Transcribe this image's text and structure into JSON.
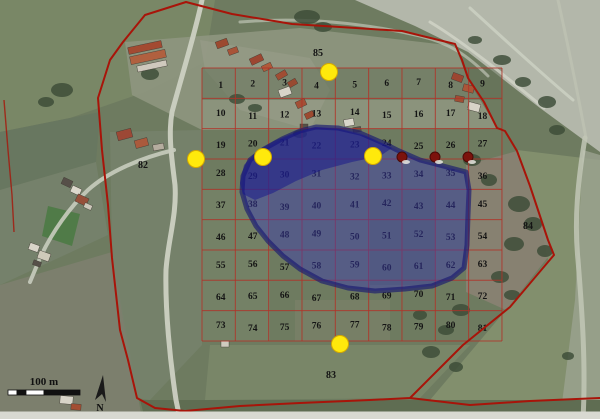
{
  "figure": {
    "kind": "satellite-map-with-sampling-grid",
    "width": 600,
    "height": 419
  },
  "colors": {
    "base_ground": "#6e7b60",
    "grid_line": "#b03328",
    "boundary_line": "#a81409",
    "flood_fill": "#3a3ab4",
    "flood_edge": "#191970",
    "flood_dark_patch": "#14148c",
    "sample_dot": "#ffe90c",
    "sample_dot_edge": "#d4a900",
    "well_dot": "#7c120c",
    "number_text": "#141414",
    "road": "#ccd0c2",
    "tree": "#3c4c37",
    "bottom_margin": "#d8d9d1"
  },
  "grid": {
    "x0": 202,
    "y0": 68,
    "cols": 9,
    "rows": 9,
    "cell_w": 33.33,
    "cell_h": 30.33,
    "numbers": [
      1,
      2,
      3,
      4,
      5,
      6,
      7,
      8,
      9,
      10,
      11,
      12,
      13,
      14,
      15,
      16,
      17,
      18,
      19,
      20,
      21,
      22,
      23,
      24,
      25,
      26,
      27,
      28,
      29,
      30,
      31,
      32,
      33,
      34,
      35,
      36,
      37,
      38,
      39,
      40,
      41,
      42,
      43,
      44,
      45,
      46,
      47,
      48,
      49,
      50,
      51,
      52,
      53,
      54,
      55,
      56,
      57,
      58,
      59,
      60,
      61,
      62,
      63,
      64,
      65,
      66,
      67,
      68,
      69,
      70,
      71,
      72,
      73,
      74,
      75,
      76,
      77,
      78,
      79,
      80,
      81
    ]
  },
  "outlying_labels": [
    {
      "text": "82",
      "x": 143,
      "y": 168
    },
    {
      "text": "83",
      "x": 331,
      "y": 378
    },
    {
      "text": "84",
      "x": 528,
      "y": 229
    },
    {
      "text": "85",
      "x": 318,
      "y": 56
    }
  ],
  "sample_points": [
    {
      "x": 329,
      "y": 72
    },
    {
      "x": 196,
      "y": 159
    },
    {
      "x": 263,
      "y": 157
    },
    {
      "x": 373,
      "y": 156
    },
    {
      "x": 340,
      "y": 344
    }
  ],
  "well_points": [
    {
      "x": 402,
      "y": 157
    },
    {
      "x": 435,
      "y": 157
    },
    {
      "x": 468,
      "y": 157
    }
  ],
  "boundary": {
    "main": "186,2 232,14 292,24 356,28 402,31 455,44 462,60 468,78 484,102 497,128 505,131 517,151 530,186 537,207 548,240 554,255 548,262 510,307 463,345 410,398 370,400 300,403 240,406 185,411 155,408 137,398 128,360 120,330 112,258 108,205 102,150 98,98 110,60 123,42 145,15",
    "bottom_ext": "410,398 470,405 530,401 600,398",
    "left_spur": "4,100 8,150 12,195 14,232"
  },
  "flood_zone": {
    "outline": "243,176 250,160 264,149 282,139 300,131 316,127 338,128 360,133 383,143 397,150 420,160 447,167 466,172 469,190 468,215 467,245 464,268 452,278 432,286 405,289 375,291 348,288 322,281 300,269 283,256 268,241 256,226 247,209 242,192",
    "dark_patch": "240,183 244,165 256,152 274,141 296,132 315,127 340,129 366,136 392,148 380,156 352,162 322,170 296,181 273,193 255,200 243,194"
  },
  "terrain": {
    "fields": [
      {
        "name": "tl-field-a",
        "pts": "0,0 215,0 205,62 145,92 70,118 0,132",
        "fill": "#798766",
        "op": 1
      },
      {
        "name": "tl-field-b",
        "pts": "0,132 100,112 96,162 0,190",
        "fill": "#687760",
        "op": 1
      },
      {
        "name": "tl-field-c",
        "pts": "0,190 96,162 108,235 0,285",
        "fill": "#75816b",
        "op": 1
      },
      {
        "name": "bl-field",
        "pts": "0,285 112,252 128,340 142,419 0,419",
        "fill": "#7c7f6d",
        "op": 1
      },
      {
        "name": "green-strip",
        "pts": "48,206 80,214 72,246 42,236",
        "fill": "#4d7a45",
        "op": 0.9
      },
      {
        "name": "top-band",
        "pts": "125,42 300,28 455,46 468,80 497,128 202,130 132,95",
        "fill": "#8e9680",
        "op": 0.9
      },
      {
        "name": "village-ground",
        "pts": "200,40 310,58 330,90 310,130 240,110 205,70",
        "fill": "#9a9d8a",
        "op": 0.6
      },
      {
        "name": "ne-scrubland",
        "pts": "355,0 600,0 600,152 540,108 468,52 415,26",
        "fill": "#b3b7aa",
        "op": 1
      },
      {
        "name": "e-zone",
        "pts": "517,150 600,160 600,400 430,400 548,260 537,207",
        "fill": "#84916f",
        "op": 0.9
      },
      {
        "name": "far-right-strip",
        "pts": "583,150 600,155 600,419 560,419 575,300",
        "fill": "#9ba390",
        "op": 0.8
      },
      {
        "name": "s-zone",
        "pts": "140,400 600,400 600,419 145,419",
        "fill": "#5f6d52",
        "op": 1
      },
      {
        "name": "se-field",
        "pts": "210,345 470,345 420,398 205,400",
        "fill": "#7b886a",
        "op": 0.85
      },
      {
        "name": "center-left",
        "pts": "110,132 202,130 202,345 150,400 137,398 125,330 112,255",
        "fill": "#76826c",
        "op": 0.9
      },
      {
        "name": "grid-top-row",
        "pts": "202,68 502,68 502,100 202,100",
        "fill": "#5f6e53",
        "op": 0.5
      },
      {
        "name": "grid-left-light",
        "pts": "202,190 270,190 270,341 202,341",
        "fill": "#7a886b",
        "op": 0.5
      },
      {
        "name": "grid-mid-dark",
        "pts": "370,190 435,190 435,285 370,285",
        "fill": "#5c6b51",
        "op": 0.45
      },
      {
        "name": "grid-bottom-tan",
        "pts": "295,300 390,300 390,341 295,341",
        "fill": "#80836b",
        "op": 0.5
      },
      {
        "name": "brown-ne-patch",
        "pts": "466,165 517,151 537,207 552,252 506,310 466,292",
        "fill": "#8a8273",
        "op": 0.9
      }
    ],
    "roads": [
      {
        "name": "main-road",
        "d": "M202,0 C196,30 182,75 172,112 C168,135 172,160 175,185 C177,215 168,240 166,270 C165,310 170,360 176,400 L180,419",
        "w": 5,
        "stroke": "#ccd0c2",
        "op": 0.95
      },
      {
        "name": "west-branch-road",
        "d": "M174,150 C140,158 108,172 88,190 C70,207 52,232 40,258 L30,282",
        "w": 4,
        "stroke": "#c8ccbe",
        "op": 0.9
      },
      {
        "name": "right-road",
        "d": "M585,138 C578,180 574,220 578,260 C582,310 586,365 583,419",
        "w": 5,
        "stroke": "#c2c7b6",
        "op": 0.85
      },
      {
        "name": "right-road-upper",
        "d": "M558,0 C568,45 578,95 586,138",
        "w": 3,
        "stroke": "#c2c7b6",
        "op": 0.6
      },
      {
        "name": "ne-trail",
        "d": "M240,22 C300,17 360,22 420,36 C450,43 468,56 488,76",
        "w": 3,
        "stroke": "#c5c9bb",
        "op": 0.65
      },
      {
        "name": "riverbed-streak",
        "d": "M430,22 C468,45 510,80 544,108",
        "w": 3,
        "stroke": "#d2d5c8",
        "op": 0.8
      },
      {
        "name": "riverbed-streak",
        "d": "M470,8 C505,40 543,75 573,100",
        "w": 3,
        "stroke": "#d2d5c8",
        "op": 0.7
      }
    ],
    "trees": [
      [
        307,
        17,
        13,
        7
      ],
      [
        323,
        27,
        9,
        5
      ],
      [
        237,
        99,
        8,
        5
      ],
      [
        255,
        108,
        7,
        4
      ],
      [
        150,
        74,
        9,
        6
      ],
      [
        62,
        90,
        11,
        7
      ],
      [
        46,
        102,
        8,
        5
      ],
      [
        519,
        204,
        11,
        8
      ],
      [
        533,
        224,
        9,
        7
      ],
      [
        514,
        244,
        10,
        7
      ],
      [
        545,
        251,
        8,
        6
      ],
      [
        500,
        277,
        9,
        6
      ],
      [
        512,
        295,
        8,
        5
      ],
      [
        472,
        160,
        9,
        6
      ],
      [
        489,
        180,
        8,
        6
      ],
      [
        461,
        310,
        9,
        6
      ],
      [
        446,
        330,
        8,
        5
      ],
      [
        431,
        352,
        9,
        6
      ],
      [
        456,
        367,
        7,
        5
      ],
      [
        568,
        356,
        6,
        4
      ],
      [
        502,
        60,
        9,
        5
      ],
      [
        523,
        82,
        8,
        5
      ],
      [
        547,
        102,
        9,
        6
      ],
      [
        475,
        40,
        7,
        4
      ],
      [
        557,
        130,
        8,
        5
      ],
      [
        420,
        315,
        7,
        5
      ],
      [
        300,
        134,
        7,
        4
      ]
    ],
    "buildings": [
      [
        128,
        44,
        34,
        7,
        -12,
        "#a34a32"
      ],
      [
        130,
        53,
        36,
        8,
        -12,
        "#b0603f"
      ],
      [
        137,
        63,
        30,
        6,
        -12,
        "#cfc9bd"
      ],
      [
        216,
        40,
        12,
        7,
        -20,
        "#9c4a30"
      ],
      [
        228,
        48,
        10,
        6,
        -20,
        "#a85438"
      ],
      [
        250,
        56,
        13,
        7,
        -25,
        "#9c4631"
      ],
      [
        262,
        64,
        10,
        6,
        -25,
        "#b05a3a"
      ],
      [
        276,
        72,
        11,
        6,
        -30,
        "#a04d33"
      ],
      [
        288,
        80,
        9,
        6,
        -30,
        "#984a31"
      ],
      [
        279,
        88,
        12,
        8,
        -20,
        "#d8d4c8"
      ],
      [
        296,
        100,
        10,
        7,
        -25,
        "#a35036"
      ],
      [
        305,
        112,
        9,
        6,
        -25,
        "#9c4a30"
      ],
      [
        300,
        124,
        8,
        6,
        0,
        "#574f47"
      ],
      [
        344,
        119,
        10,
        7,
        -10,
        "#d9d6cb"
      ],
      [
        353,
        127,
        8,
        5,
        -10,
        "#5a544c"
      ],
      [
        452,
        74,
        11,
        7,
        20,
        "#9c4631"
      ],
      [
        463,
        85,
        11,
        7,
        15,
        "#aa5638"
      ],
      [
        455,
        96,
        9,
        6,
        10,
        "#a04d33"
      ],
      [
        468,
        103,
        12,
        8,
        15,
        "#d7d3c7"
      ],
      [
        117,
        130,
        15,
        9,
        -15,
        "#9c4835"
      ],
      [
        135,
        139,
        13,
        8,
        -15,
        "#aa5a3c"
      ],
      [
        153,
        144,
        11,
        6,
        -10,
        "#b5ad9f"
      ],
      [
        62,
        179,
        10,
        7,
        25,
        "#564f48"
      ],
      [
        71,
        187,
        10,
        7,
        25,
        "#dcd8cc"
      ],
      [
        76,
        196,
        12,
        8,
        25,
        "#96503a"
      ],
      [
        84,
        204,
        8,
        5,
        25,
        "#ccc7ba"
      ],
      [
        29,
        244,
        10,
        7,
        20,
        "#d9d5c9"
      ],
      [
        38,
        252,
        12,
        8,
        20,
        "#cfcaba"
      ],
      [
        33,
        261,
        8,
        5,
        20,
        "#565049"
      ],
      [
        60,
        396,
        13,
        8,
        5,
        "#d8d4c8"
      ],
      [
        71,
        404,
        10,
        6,
        5,
        "#a34e33"
      ],
      [
        221,
        341,
        8,
        6,
        0,
        "#cfcbbf"
      ]
    ]
  },
  "scale_bar": {
    "label": "100 m",
    "x": 8,
    "y": 390,
    "h": 5,
    "segments": [
      {
        "w": 9,
        "fill": "#ffffff"
      },
      {
        "w": 9,
        "fill": "#111111"
      },
      {
        "w": 18,
        "fill": "#ffffff"
      },
      {
        "w": 36,
        "fill": "#111111"
      }
    ]
  },
  "north_arrow": {
    "label": "N",
    "x": 101,
    "y": 389
  }
}
